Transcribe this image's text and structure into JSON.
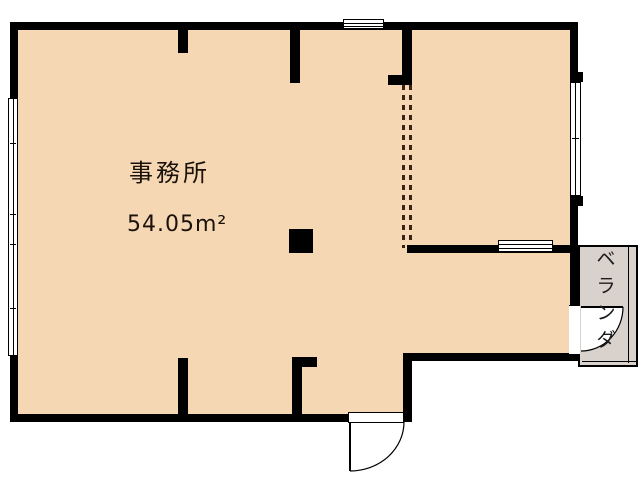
{
  "floorplan": {
    "room": {
      "name": "事務所",
      "area": "54.05m²"
    },
    "balcony": {
      "label": "ベランダ",
      "chars": [
        "ベ",
        "ラ",
        "ン",
        "ダ"
      ]
    },
    "colors": {
      "wall": "#000000",
      "floor": "#f5d7b3",
      "balcony_floor": "#d9d1cc",
      "background": "#ffffff",
      "partition_dash": "#3a2315"
    }
  }
}
